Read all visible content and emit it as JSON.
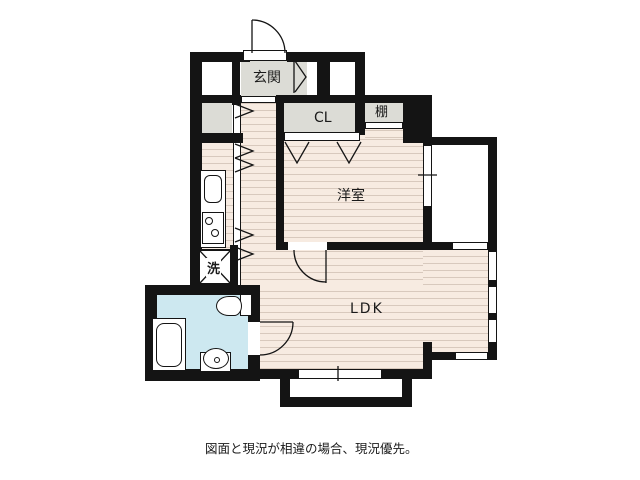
{
  "plan": {
    "labels": {
      "genkan": "玄関",
      "closet": "CL",
      "shelf": "棚",
      "western_room": "洋室",
      "ldk": "LDK",
      "washer": "洗"
    },
    "caption": "図面と現況が相違の場合、現況優先。",
    "colors": {
      "wall": "#141414",
      "floor_pink": "#f7ebe1",
      "floor_stripe": "#d8c9bd",
      "room_gray": "#dcdcd6",
      "bath_blue": "#cde8f0"
    }
  }
}
